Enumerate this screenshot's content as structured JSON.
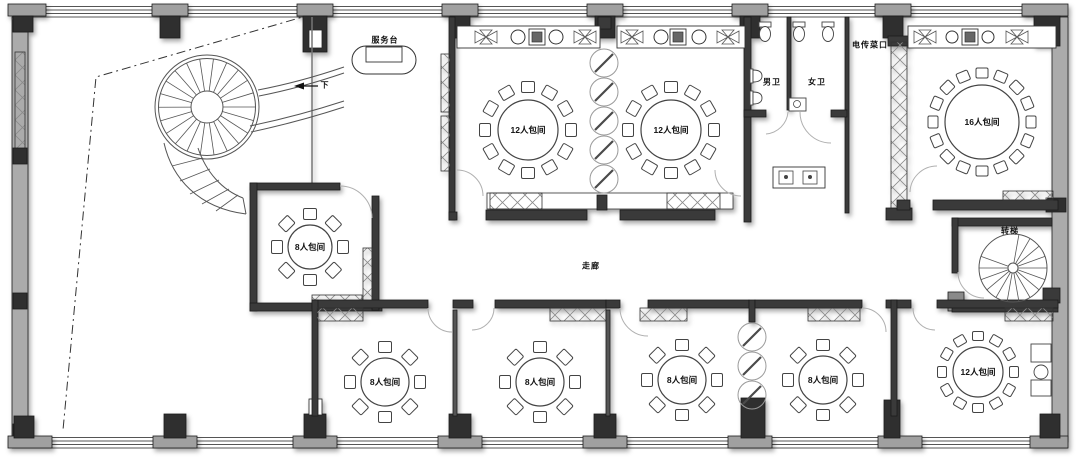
{
  "labels": {
    "service_desk": "服务台",
    "down": "下",
    "mens_toilet": "男卫",
    "womens_toilet": "女卫",
    "food_lift": "电传菜口",
    "corridor": "走廊",
    "spiral_stair": "转梯"
  },
  "rooms": [
    {
      "id": "room-12-top-left",
      "label": "12人包间",
      "cx": 528,
      "cy": 130,
      "table_r": 30,
      "seat_r": 43,
      "seats": 12,
      "chair_w": 13,
      "chair_h": 11
    },
    {
      "id": "room-12-top-right",
      "label": "12人包间",
      "cx": 671,
      "cy": 130,
      "table_r": 30,
      "seat_r": 43,
      "seats": 12,
      "chair_w": 13,
      "chair_h": 11
    },
    {
      "id": "room-16",
      "label": "16人包间",
      "cx": 982,
      "cy": 122,
      "table_r": 37,
      "seat_r": 49,
      "seats": 16,
      "chair_w": 12,
      "chair_h": 10
    },
    {
      "id": "room-8-west",
      "label": "8人包间",
      "cx": 310,
      "cy": 247,
      "table_r": 22,
      "seat_r": 33,
      "seats": 8,
      "chair_w": 13,
      "chair_h": 11
    },
    {
      "id": "room-8-south-1",
      "label": "8人包间",
      "cx": 385,
      "cy": 382,
      "table_r": 24,
      "seat_r": 35,
      "seats": 8,
      "chair_w": 13,
      "chair_h": 11
    },
    {
      "id": "room-8-south-2",
      "label": "8人包间",
      "cx": 540,
      "cy": 382,
      "table_r": 24,
      "seat_r": 35,
      "seats": 8,
      "chair_w": 13,
      "chair_h": 11
    },
    {
      "id": "room-8-south-3",
      "label": "8人包间",
      "cx": 682,
      "cy": 380,
      "table_r": 24,
      "seat_r": 35,
      "seats": 8,
      "chair_w": 13,
      "chair_h": 11
    },
    {
      "id": "room-8-south-4",
      "label": "8人包间",
      "cx": 823,
      "cy": 380,
      "table_r": 24,
      "seat_r": 35,
      "seats": 8,
      "chair_w": 13,
      "chair_h": 11
    },
    {
      "id": "room-12-south",
      "label": "12人包间",
      "cx": 978,
      "cy": 372,
      "table_r": 25,
      "seat_r": 36,
      "seats": 12,
      "chair_w": 11,
      "chair_h": 9
    }
  ],
  "colors": {
    "wall": "#3a3a3a",
    "wall_light": "#ababab",
    "cap": "#a0a0a0",
    "line": "#222222",
    "furniture_stroke": "#444444",
    "arc": "#b5b5b5"
  }
}
